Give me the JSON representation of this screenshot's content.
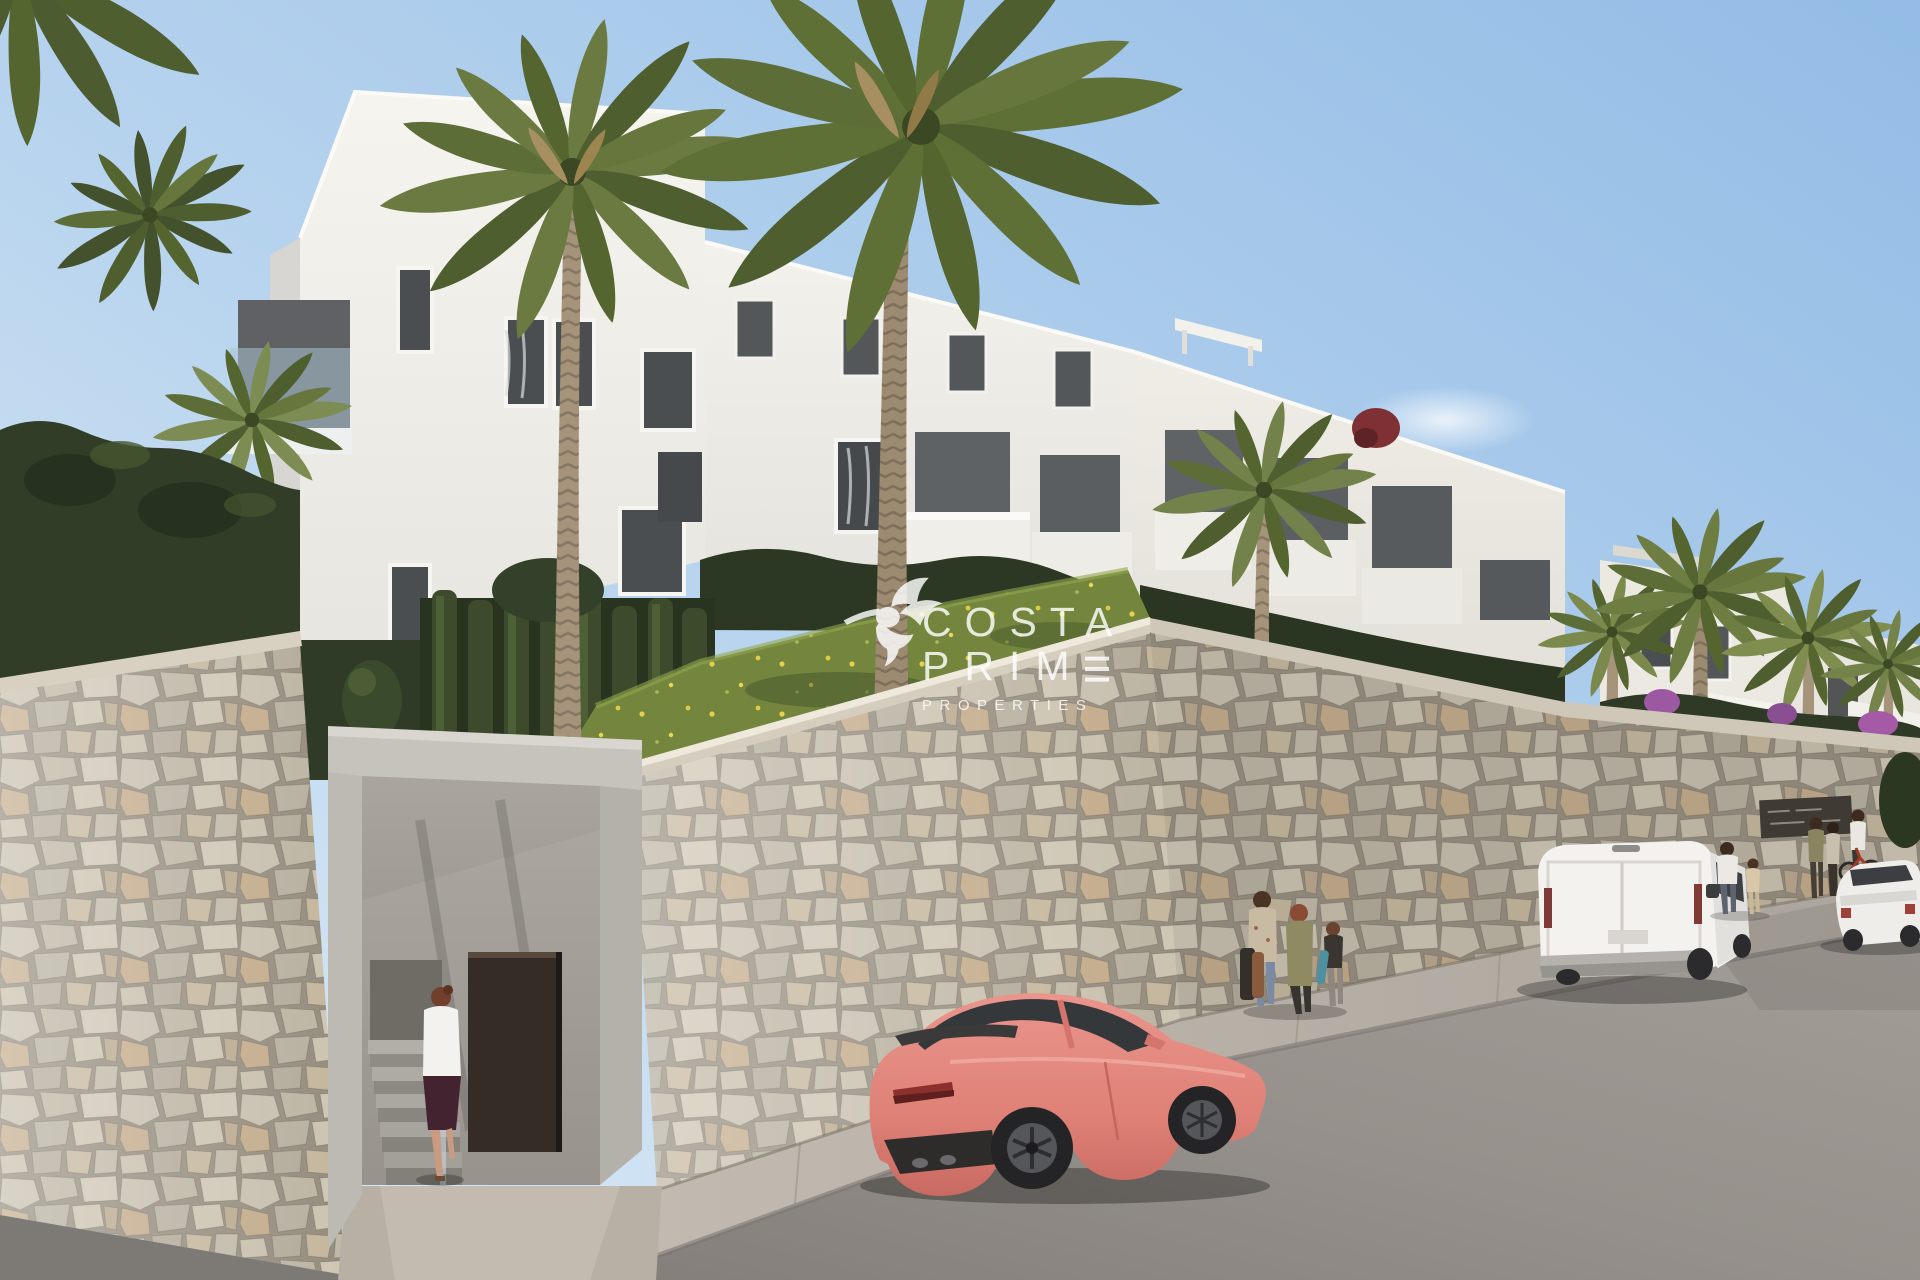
{
  "scene": {
    "kind": "architectural-exterior-render",
    "description": "Modern white apartment complex above beige stone retaining walls on a curved street, with palm trees, a pedestrian entrance with stairs, people walking, a coral sports coupe, a white delivery van and a white sedan parked along the road."
  },
  "watermark": {
    "line1": "COSTA",
    "line2": "PRIME",
    "line3": "PROPERTIES",
    "logo": "hummingbird-icon",
    "text_color": "#ffffff"
  },
  "palette": {
    "sky_top": "#9cc3e8",
    "sky_horizon": "#ddebf6",
    "building_white": "#f2f0ea",
    "stone_wall": "#c1b9a7",
    "grass_green": "#75873f",
    "palm_green": "#65753b",
    "hedge_green": "#2e3a26",
    "coupe_coral": "#e08278",
    "van_white": "#f3f2ef",
    "asphalt_gray": "#938e89",
    "door_brown": "#372f27"
  }
}
